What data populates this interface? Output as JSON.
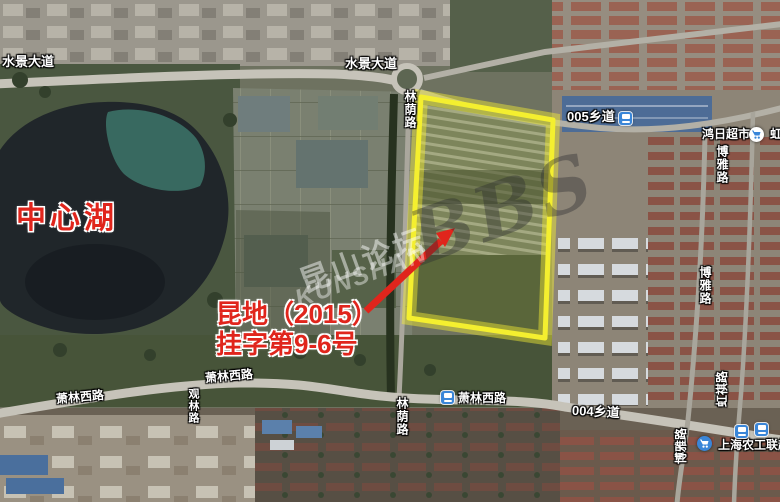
{
  "colors": {
    "parcel_outline": "#f4ef2f",
    "parcel_glow": "rgba(246,240,50,0.45)",
    "parcel_fill": "rgba(246,240,50,0.10)",
    "annotation_red": "#e0251c",
    "poi_blue": "#3a86d8"
  },
  "roads": {
    "shuijing_w": "水景大道",
    "shuijing_c": "水景大道",
    "linyin_n": "林荫路",
    "linyin_s": "林荫路",
    "xiang005": "005乡道",
    "xiang004": "004乡道",
    "boya_n": "博雅路",
    "boya_m": "博雅路",
    "boya_s": "博雅路",
    "hongqi_ne": "虹祺路",
    "hongqi_s": "虹祺路",
    "guanlin": "观林路",
    "xiaolin_w1": "萧林西路",
    "xiaolin_w2": "萧林西路",
    "xiaolin_c": "萧林西路"
  },
  "pois": {
    "hongri_supermarket": "鸿日超市",
    "shanghai_nonggong": "上海农工联超"
  },
  "annotations": {
    "lake_label": "中心湖",
    "parcel_label_line1": "昆地（2015）",
    "parcel_label_line2": "挂字第9-6号"
  },
  "watermark": {
    "cn": "昆山论坛",
    "en": "KUNSHAN",
    "bbs": "BBS"
  }
}
